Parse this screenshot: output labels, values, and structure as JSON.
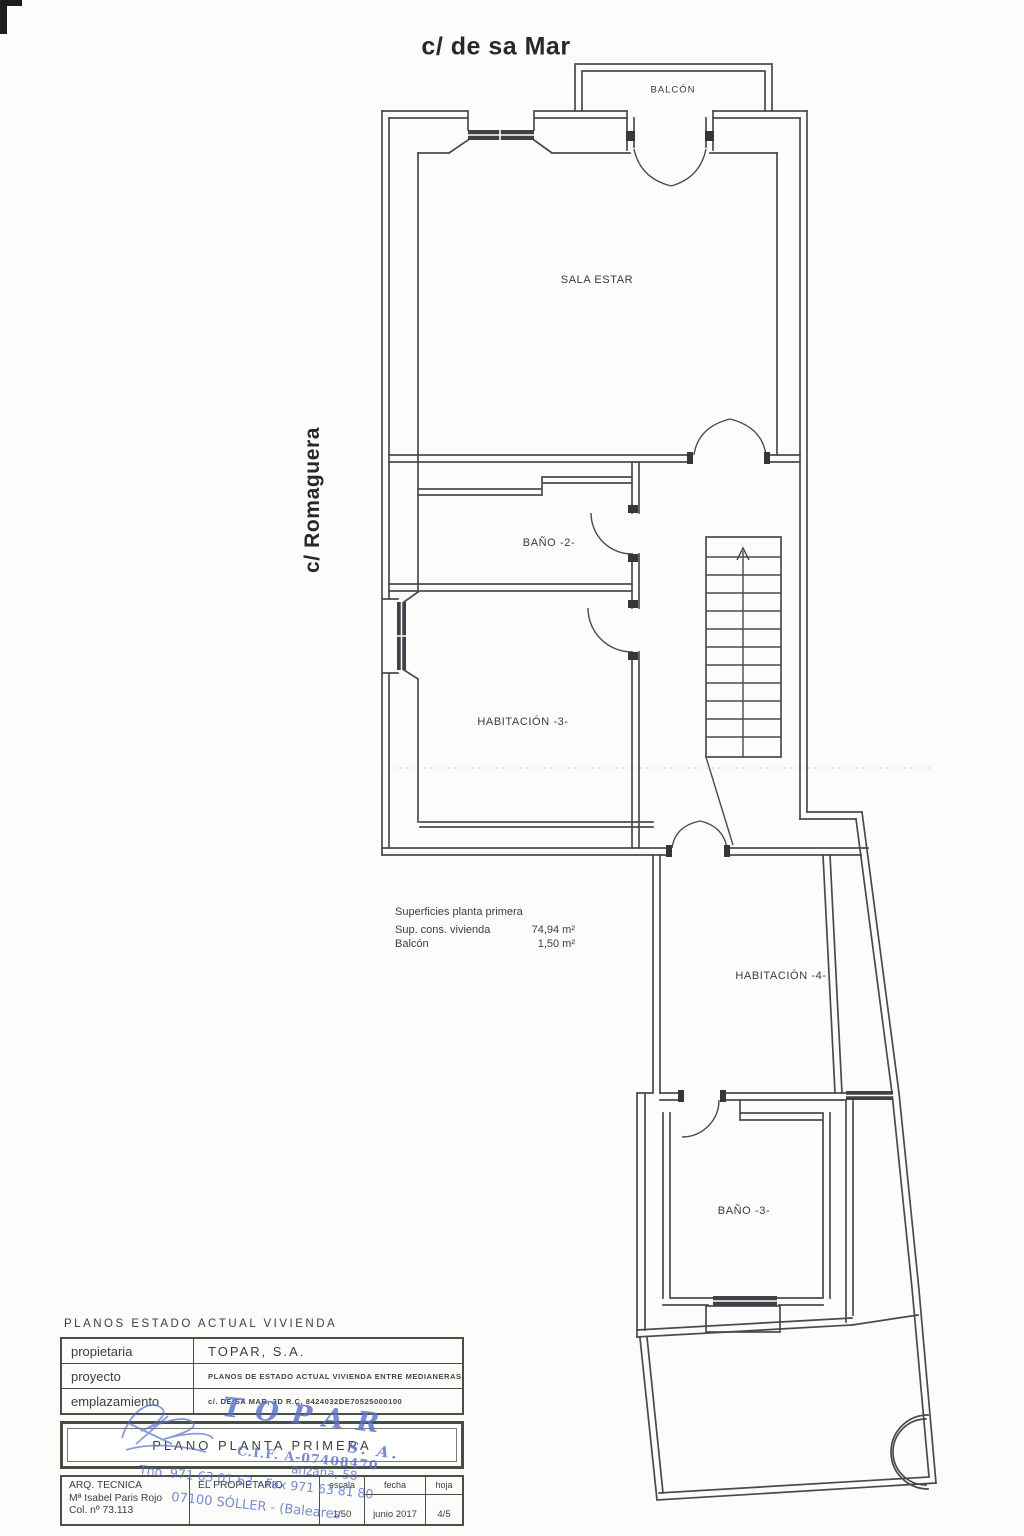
{
  "streets": {
    "top": "c/ de sa Mar",
    "left": "c/ Romaguera"
  },
  "rooms": {
    "balcon": "BALCÓN",
    "sala_estar": "SALA ESTAR",
    "bano2": "BAÑO -2-",
    "habitacion3": "HABITACIÓN -3-",
    "habitacion4": "HABITACIÓN -4-",
    "bano3": "BAÑO -3-"
  },
  "surfaces": {
    "title": "Superficies planta primera",
    "rows": [
      {
        "label": "Sup. cons. vivienda",
        "value": "74,94 m²"
      },
      {
        "label": "Balcón",
        "value": "1,50 m²"
      }
    ]
  },
  "titleblock": {
    "heading": "PLANOS  ESTADO  ACTUAL  VIVIENDA",
    "rows": [
      {
        "label": "propietaria",
        "value": "TOPAR,  S.A."
      },
      {
        "label": "proyecto",
        "value": "PLANOS  DE  ESTADO  ACTUAL  VIVIENDA  ENTRE  MEDIANERAS"
      },
      {
        "label": "emplazamiento",
        "value": "c/.  DE  SA  MAR,  3D    R.C.  8424032DE70525000100"
      }
    ],
    "plan_title": "PLANO  PLANTA  PRIMERA",
    "arq_line1": "ARQ.  TECNICA",
    "arq_line2": "Mª  Isabel  Paris  Rojo",
    "arq_line3": "Col.  nº  73.113",
    "propietario_label": "EL  PROPIETARIO",
    "escala": {
      "label": "escala",
      "value": "1/50"
    },
    "fecha": {
      "label": "fecha",
      "value": "junio  2017"
    },
    "hoja": {
      "label": "hoja",
      "value": "4/5"
    }
  },
  "stamp": {
    "company": "TOPAR",
    "sa": "S. A.",
    "cif": "C.I.F. A-07408470",
    "addr1": "anzana, 58",
    "addr2": "Tno. 971 63 01 63 - Fax 971 63 81 80",
    "addr3": "07100 SÓLLER - (Baleares"
  }
}
